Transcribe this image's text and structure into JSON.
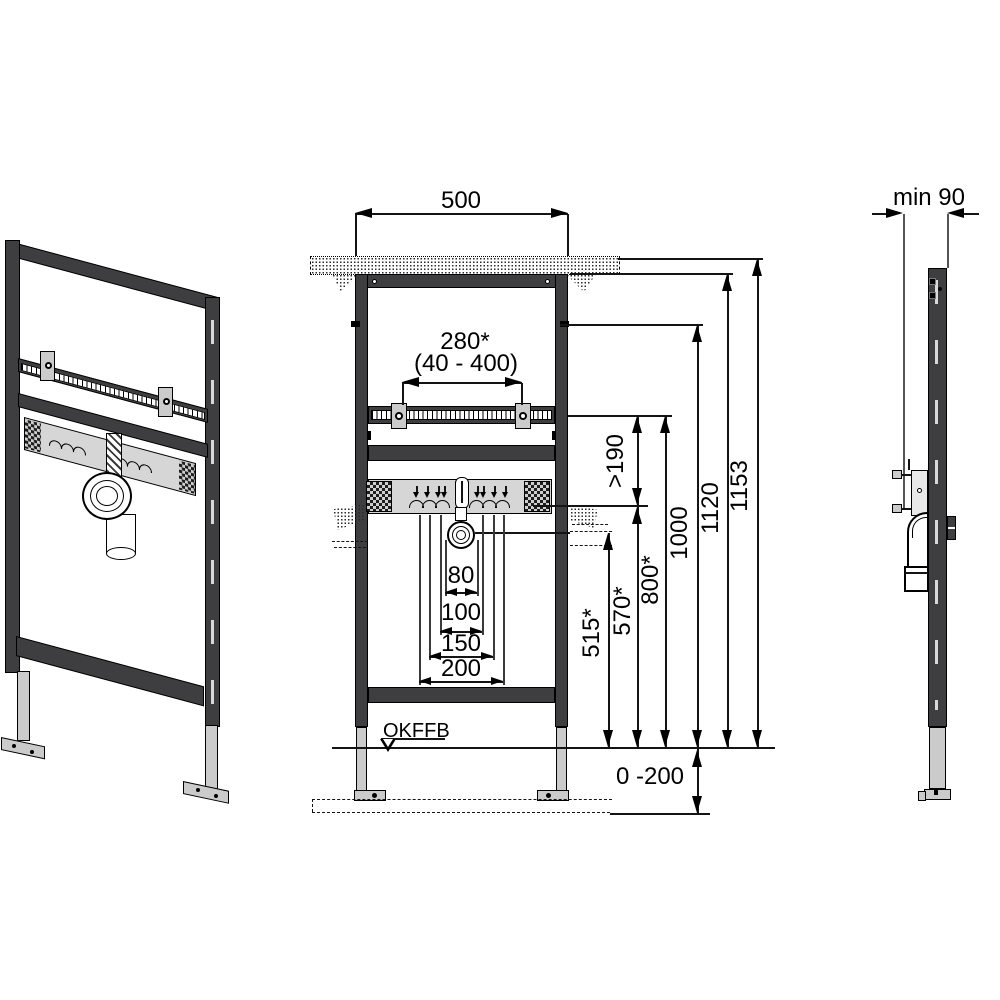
{
  "title": "Washbasin mounting frame installation drawing",
  "colors": {
    "line": "#141414",
    "frame_dark": "#3e3e40",
    "metal_light": "#cbcbcb",
    "plate_gray": "#d6d6d6",
    "background": "#ffffff"
  },
  "front_view": {
    "dim_frame_width": "500",
    "dim_tap_spacing": "280*",
    "dim_tap_spacing_range": "(40 - 400)",
    "dim_clearance": ">190",
    "dim_height_total": "1153",
    "dim_height_upper_edge": "1120",
    "dim_height_meter_mark": "1000",
    "dim_height_rail": "800*",
    "dim_height_supply": "570*",
    "dim_height_drain": "515*",
    "dim_drain_offset_80": "80",
    "dim_drain_offset_100": "100",
    "dim_drain_offset_150": "150",
    "dim_drain_offset_200": "200",
    "floor_level_label": "OKFFB",
    "dim_floor_adjustment": "0 -200"
  },
  "side_view": {
    "dim_min_depth": "min 90"
  }
}
